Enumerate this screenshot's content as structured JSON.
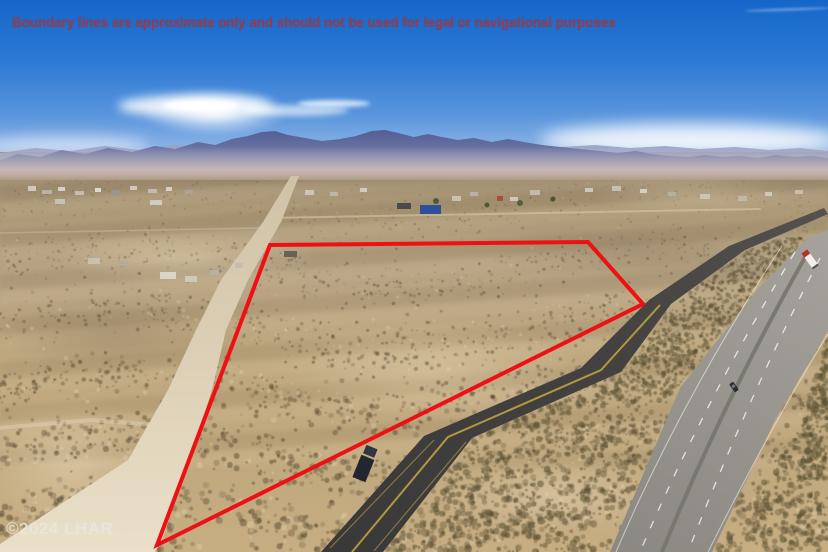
{
  "overlay": {
    "disclaimer": "Boundary lines are approximate only and should not be used for legal or navigational purposes",
    "watermark": "©2024 LHAR"
  },
  "scene": {
    "description": "Aerial drone photo of a vacant desert land parcel outlined with a red boundary polygon, bordered by a dirt road on the west and a paved frontage road and divided highway on the east, mountains on the horizon"
  },
  "colors": {
    "boundary_color": "#ee1013",
    "disclaimer_color": "#9e3a46",
    "watermark_color": "#e9e7e3",
    "sky_top": "#1566c9",
    "sky_horizon": "#cfe0ef",
    "mountain_main": "#4d5890",
    "mountain_far": "#98a0c4",
    "desert_dark": "#a89573",
    "desert_mid": "#c6ad82",
    "dirt_road_color": "#ddd0b6",
    "asphalt_color": "#3f3e3e",
    "highway_color": "#95928c",
    "yellow_line": "#c7a83e"
  }
}
